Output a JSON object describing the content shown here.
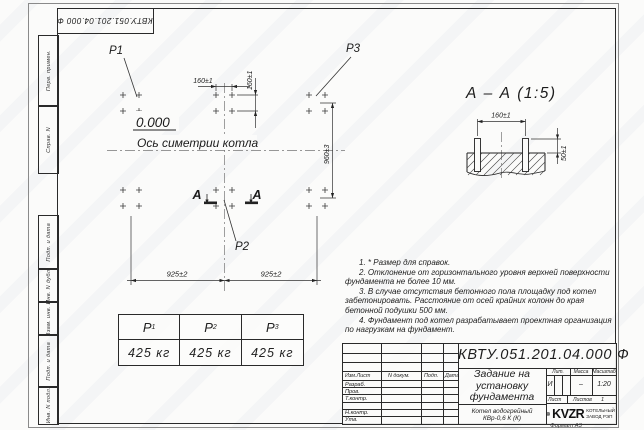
{
  "stamp_top": "КВТУ.051.201.04.000 Ф",
  "margin": {
    "labels": [
      "Перв. примен.",
      "Справ. N",
      "Подп. и дата",
      "Инв. N дубл.",
      "Взам. инв. N",
      "Подп. и дата",
      "Инв. N подл."
    ]
  },
  "plan": {
    "p1": "P1",
    "p2": "P2",
    "p3": "P3",
    "elevation": "0.000",
    "axis_label": "Ось симетрии котла",
    "dim_x160": "160±1",
    "dim_y160": "160±1",
    "dim_h960": "960±3",
    "dim_925_left": "925±2",
    "dim_925_right": "925±2",
    "section_letter_left": "А",
    "section_letter_right": "А"
  },
  "section": {
    "title": "А – А (1:5)",
    "dim_160": "160±1",
    "dim_50": "50±1"
  },
  "notes": [
    "1. * Размер для справок.",
    "2. Отклонение от горизонтального уровня верхней поверхности фундамента не более 10 мм.",
    "3. В случае отсутствия бетонного пола площадку под котел забетонировать. Расстояние от осей крайних колонн до края бетонной подушки 500 мм.",
    "4. Фундамент под котел разрабатывает проектная организация по нагрузкам на фундамент."
  ],
  "load_table": {
    "headers": [
      {
        "base": "P",
        "sub": "1"
      },
      {
        "base": "P",
        "sub": "2"
      },
      {
        "base": "P",
        "sub": "3"
      }
    ],
    "values": [
      "425 кг",
      "425 кг",
      "425 кг"
    ]
  },
  "title_block": {
    "doc_number": "КВТУ.051.201.04.000  Ф",
    "title_lines": [
      "Задание на",
      "установку",
      "фундамента"
    ],
    "product_lines": [
      "Котел водогрейный",
      "КВр-0,6 К (К)"
    ],
    "cols": [
      "Изм.Лист",
      "N докум.",
      "Подп.",
      "Дата"
    ],
    "rows": [
      "Разраб.",
      "Пров.",
      "Т.контр.",
      "",
      "Н.контр.",
      "Утв."
    ],
    "lit_label": "Лит.",
    "mass_label": "Масса",
    "scale_label": "Масштаб",
    "lit": "И",
    "mass": "–",
    "scale": "1:20",
    "sheet_label": "Лист",
    "sheets_label": "Листов",
    "sheets": "1",
    "logo": "KVZR",
    "company_lines": [
      "КОТЕЛЬНЫЙ",
      "ЗАВОД РЭП"
    ],
    "format": "Формат А3"
  }
}
